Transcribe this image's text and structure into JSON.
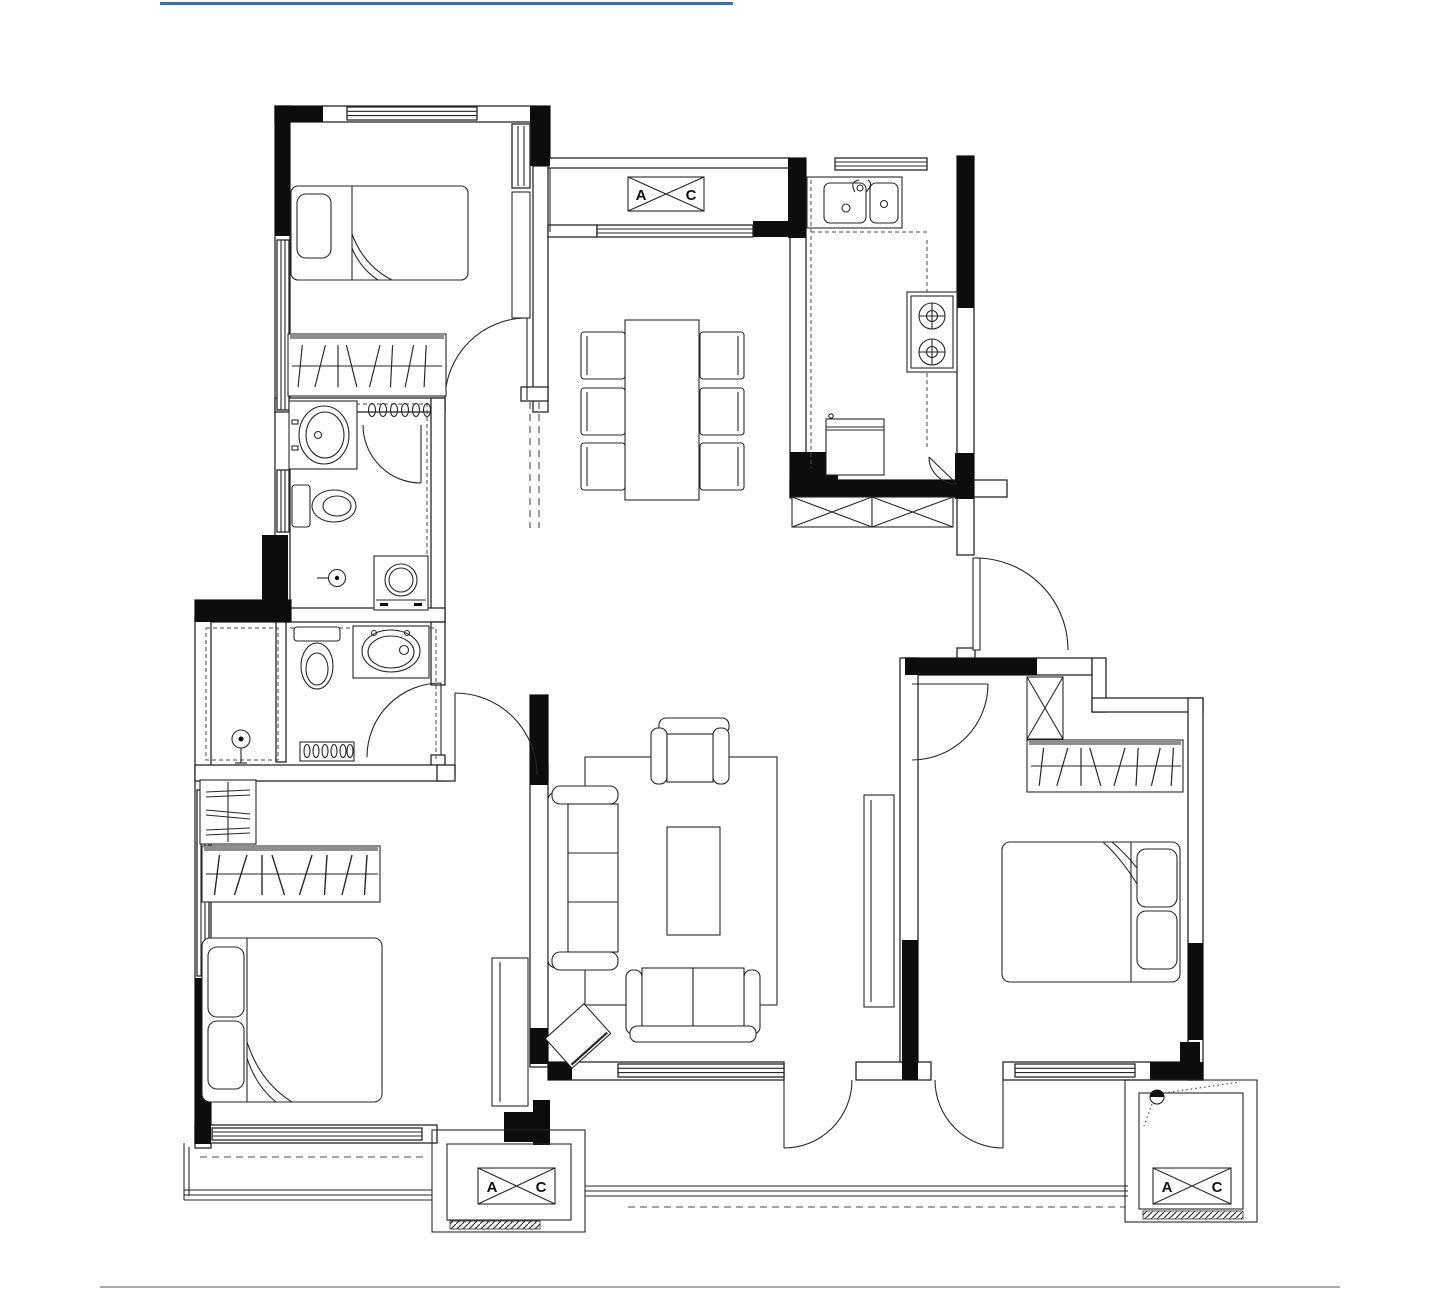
{
  "page": {
    "background": "#ffffff",
    "top_rule_color": "#2e73b8",
    "bottom_rule_color": "#a9a9a9"
  },
  "plan": {
    "ink_color": "#262626",
    "wall_fill": "#0d0d0d",
    "ac_labels": {
      "top_platform": {
        "left": "A",
        "right": "C"
      },
      "south_balcony": {
        "left": "A",
        "right": "C"
      },
      "southeast_platform": {
        "left": "A",
        "right": "C"
      }
    }
  }
}
